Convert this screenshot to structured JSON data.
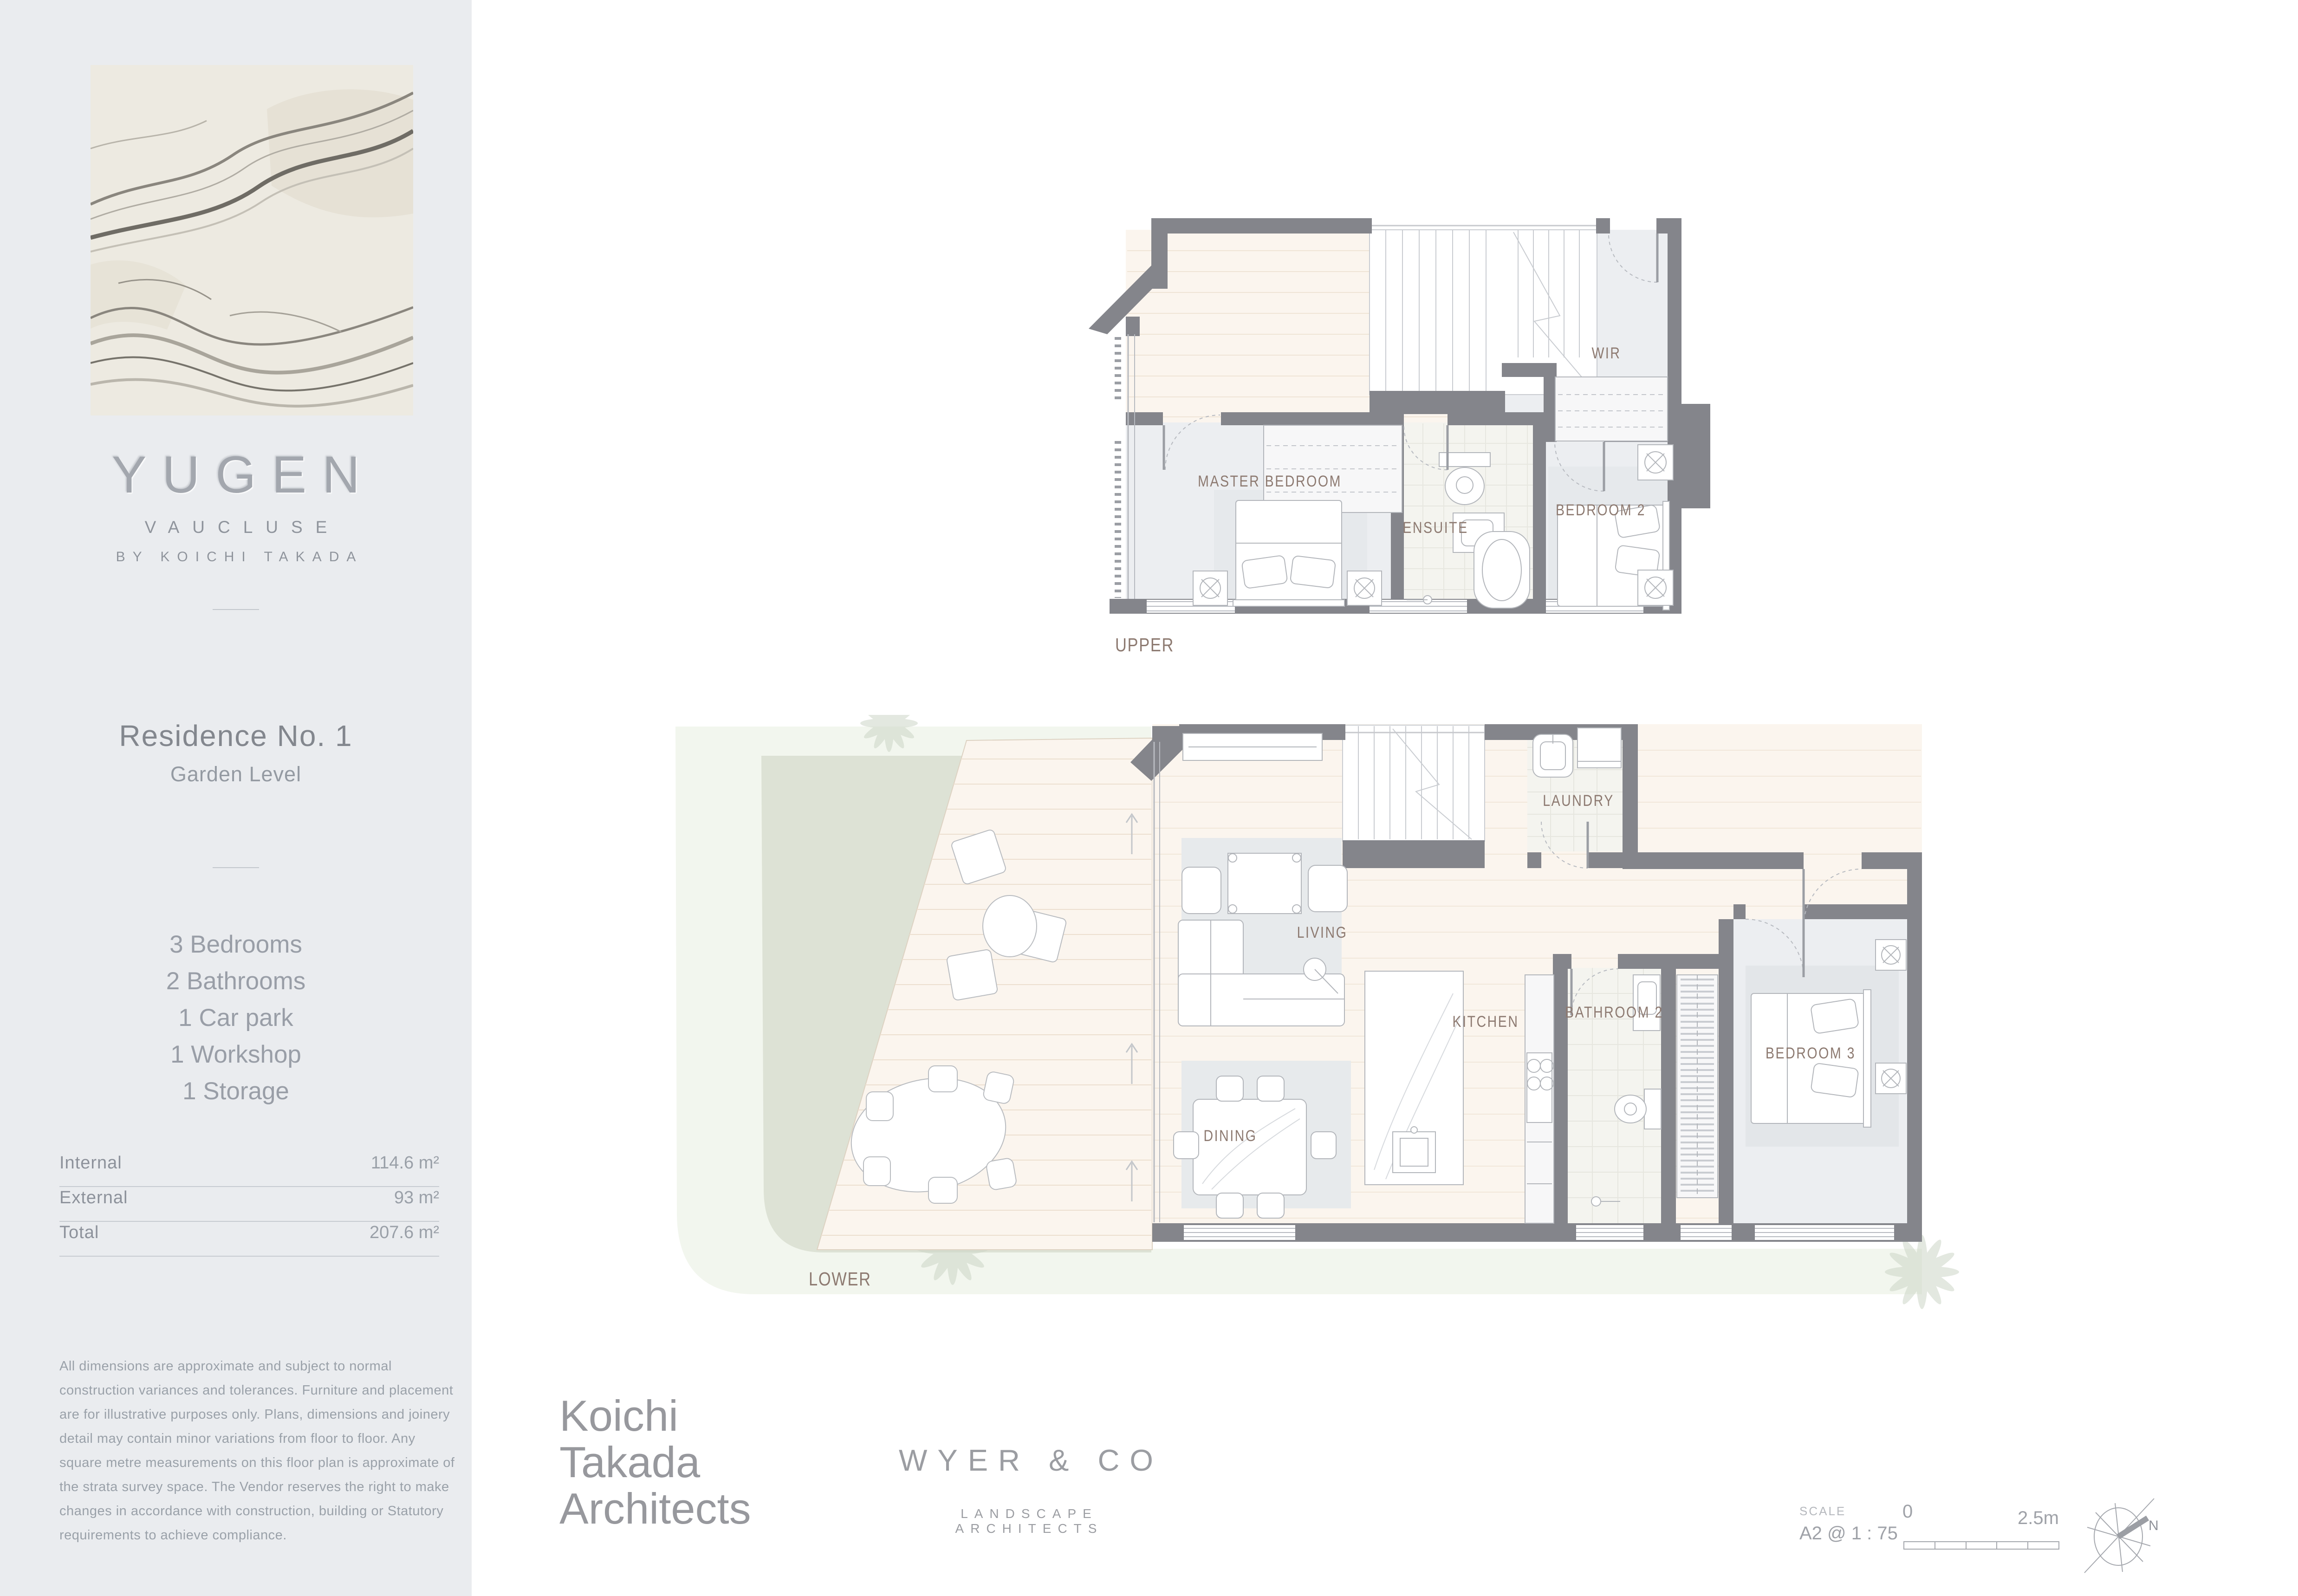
{
  "sidebar": {
    "brand": {
      "name": "YUGEN",
      "location": "VAUCLUSE",
      "byline": "BY KOICHI TAKADA"
    },
    "residence": {
      "title": "Residence No. 1",
      "subtitle": "Garden Level"
    },
    "features": [
      "3 Bedrooms",
      "2 Bathrooms",
      "1 Car park",
      "1 Workshop",
      "1 Storage"
    ],
    "areas": [
      {
        "label": "Internal",
        "value": "114.6 m²"
      },
      {
        "label": "External",
        "value": "93 m²"
      },
      {
        "label": "Total",
        "value": "207.6 m²"
      }
    ],
    "disclaimer": "All dimensions are approximate and subject to normal construction variances and tolerances. Furniture and placement are for illustrative purposes only. Plans, dimensions and joinery detail may contain minor variations from floor to floor. Any square metre measurements on this floor plan is approximate of the strata survey space. The Vendor reserves the right to make changes in accordance with construction, building or Statutory requirements to achieve compliance."
  },
  "plans": {
    "upper": {
      "level_label": "UPPER",
      "rooms": {
        "master_bedroom": "MASTER BEDROOM",
        "ensuite": "ENSUITE",
        "wir": "WIR",
        "bedroom_2": "BEDROOM 2"
      }
    },
    "lower": {
      "level_label": "LOWER",
      "rooms": {
        "living": "LIVING",
        "dining": "DINING",
        "kitchen": "KITCHEN",
        "laundry": "LAUNDRY",
        "bathroom_2": "BATHROOM 2",
        "bedroom_3": "BEDROOM 3"
      }
    }
  },
  "footer": {
    "architect_logo": {
      "line1": "Koichi",
      "line2": "Takada",
      "line3": "Architects"
    },
    "landscape_logo": {
      "name": "WYER & CO",
      "tagline": "LANDSCAPE ARCHITECTS"
    },
    "scale": {
      "label": "SCALE",
      "value": "A2 @ 1 : 75",
      "zero": "0",
      "max": "2.5m"
    },
    "compass": {
      "north": "N"
    }
  },
  "colors": {
    "wall": "#84858b",
    "floor_timber": "#fbf5ee",
    "floor_tile": "#f4f4ef",
    "room_grey": "#eceef1",
    "lawn": "#dde2d5",
    "lawn_light": "#f2f6ee",
    "label": "#8d7a71"
  }
}
